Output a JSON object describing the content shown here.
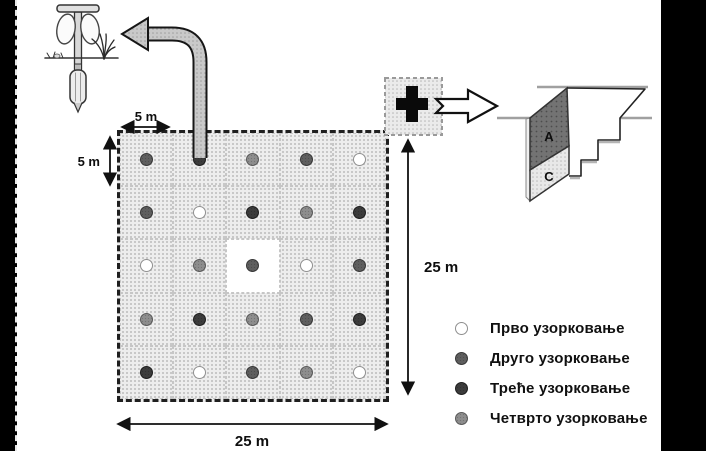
{
  "figure": {
    "description": "soil-sampling-grid-scheme"
  },
  "dimensions": {
    "cell_width_label": "5 m",
    "cell_height_label": "5 m",
    "grid_width_label": "25 m",
    "grid_height_label": "25 m"
  },
  "grid": {
    "rows": 5,
    "cols": 5,
    "cells": [
      [
        2,
        3,
        4,
        2,
        1
      ],
      [
        2,
        1,
        3,
        4,
        3
      ],
      [
        1,
        4,
        2,
        1,
        2
      ],
      [
        4,
        3,
        4,
        2,
        3
      ],
      [
        3,
        1,
        2,
        4,
        1
      ]
    ],
    "plain_white_cell": {
      "row": 2,
      "col": 2
    }
  },
  "sampling_rounds": [
    {
      "id": 1,
      "label": "Прво узорковање",
      "fill": "#ffffff",
      "stroke": "#8f8f8f"
    },
    {
      "id": 2,
      "label": "Друго узорковање",
      "fill": "#5e5e5e",
      "stroke": "#383838"
    },
    {
      "id": 3,
      "label": "Треће узорковање",
      "fill": "#3c3c3c",
      "stroke": "#1f1f1f"
    },
    {
      "id": 4,
      "label": "Четврто узорковање",
      "fill": "#8d8d8d",
      "stroke": "#5a5a5a"
    }
  ],
  "profile": {
    "label_a": "A",
    "label_c": "C"
  },
  "icons": {
    "auger": "hand-soil-auger-illustration",
    "composite_symbol": "black-plus-cross",
    "transfer_arrow": "curved-arrow-to-auger",
    "detail_arrow": "block-arrow-to-profile"
  },
  "colors": {
    "background": "#ffffff",
    "frame_bars": "#000000",
    "grid_fill": "#ededed",
    "arrow_fill": "#c9c9c9",
    "horizon_a_fill": "#737373",
    "horizon_c_fill": "#e8e8e8"
  }
}
